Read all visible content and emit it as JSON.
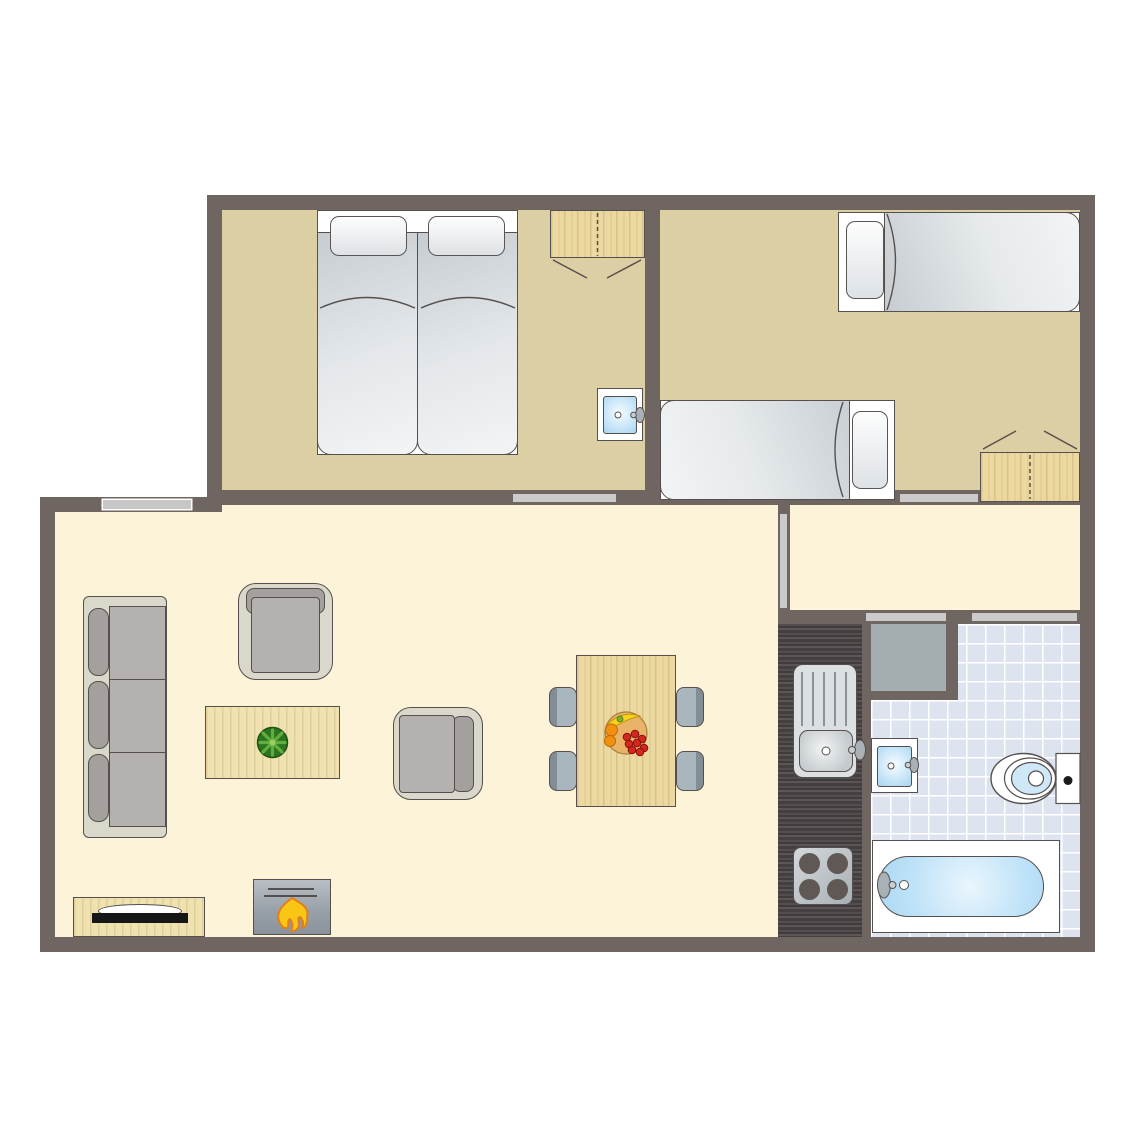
{
  "meta": {
    "kind": "apartment-floor-plan",
    "text_labels": []
  },
  "colors": {
    "wall": "#6f6662",
    "bedroom_floor": "#dccfa4",
    "living_floor": "#fcf3d8",
    "tile_floor": "#dee4ef",
    "closet": "#a3aeb1",
    "counter": "#474344",
    "wood": "#ecd9a2",
    "wood_light": "#efe2b0",
    "sofa_frame": "#d9d8ca",
    "cushion": "#b4b1af",
    "cushion_dark": "#a3a09e",
    "door_strip": "#cbcbcb",
    "window_strip": "#c7c7c7",
    "outline": "#55504e",
    "water_blue": "#bfe1f6",
    "flame_yellow": "#f9c616",
    "flame_orange": "#e0801d",
    "plant_green": "#2e7420",
    "plant_leaf": "#5eaf3e",
    "fruit_red": "#d3271f",
    "fruit_orange": "#f29111",
    "fruit_yellow": "#f7d21d",
    "tv_black": "#161616"
  },
  "rooms": [
    {
      "name": "bedroom-double",
      "furniture": [
        "double-bed",
        "two-pillows",
        "wardrobe",
        "washbasin"
      ]
    },
    {
      "name": "bedroom-twin",
      "furniture": [
        "single-bed",
        "single-bed",
        "wardrobe"
      ]
    },
    {
      "name": "living-room",
      "furniture": [
        "sofa-3-seat",
        "armchair",
        "armchair",
        "coffee-table",
        "plant",
        "tv-stand",
        "fireplace",
        "dining-table",
        "chair",
        "chair",
        "chair",
        "chair"
      ]
    },
    {
      "name": "hallway",
      "furniture": []
    },
    {
      "name": "closet",
      "furniture": []
    },
    {
      "name": "kitchen",
      "furniture": [
        "counter",
        "sink-with-drainer",
        "stove-4-burners"
      ]
    },
    {
      "name": "bathroom",
      "furniture": [
        "washbasin",
        "toilet",
        "bathtub"
      ]
    }
  ],
  "openings": {
    "windows": 1,
    "doors": 5
  }
}
